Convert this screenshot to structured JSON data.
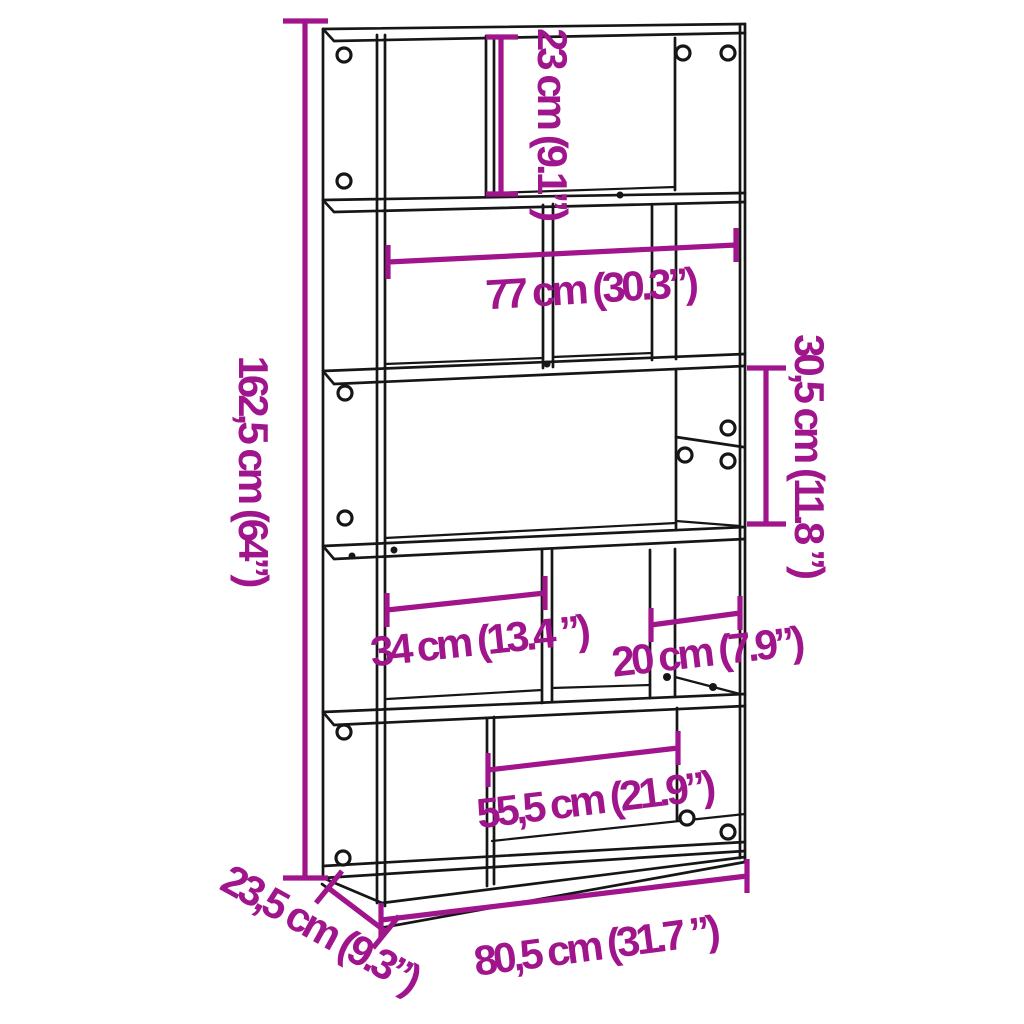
{
  "colors": {
    "dimension": "#A0148C",
    "line": "#161616",
    "background": "#FFFFFF"
  },
  "diagram": {
    "kind": "furniture-dimension-diagram",
    "subject": "5-tier-bookcase-line-drawing",
    "dimension_labels": {
      "overall_height": "162,5 cm (64”)",
      "top_compartment_height": "23 cm (9.1”)",
      "upper_inner_width": "77 cm (30.3”)",
      "middle_compartment_height": "30,5 cm (11.8 ”)",
      "left_compartment_width": "34 cm (13.4 ”)",
      "right_compartment_width": "20 cm (7.9”)",
      "bottom_compartment_width": "55,5 cm (21.9”)",
      "overall_width": "80,5 cm (31.7 ”)",
      "overall_depth": "23,5 cm (9.3”)"
    }
  }
}
